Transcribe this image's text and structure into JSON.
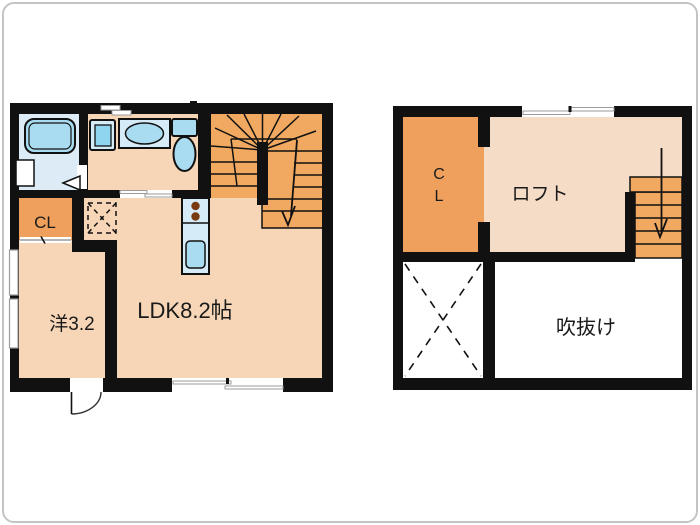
{
  "colors": {
    "wall": "#111111",
    "room": "#f6d6b6",
    "loft_room": "#f5dcc7",
    "closet": "#efa05c",
    "stairs": "#f1a962",
    "bath_floor": "#dcebf5",
    "fixture": "#aadcf1",
    "fixture_deep": "#8fd5ef",
    "counter": "#d6ebf8",
    "burner": "#7a3a10",
    "window": "#9b9b9b",
    "frame": "#c4c4c4"
  },
  "floor1": {
    "labels": {
      "closet": "CL",
      "ldk": "LDK8.2帖",
      "western": "洋3.2"
    }
  },
  "floor2": {
    "labels": {
      "closet_c": "C",
      "closet_l": "L",
      "loft": "ロフト",
      "void": "吹抜け"
    }
  }
}
